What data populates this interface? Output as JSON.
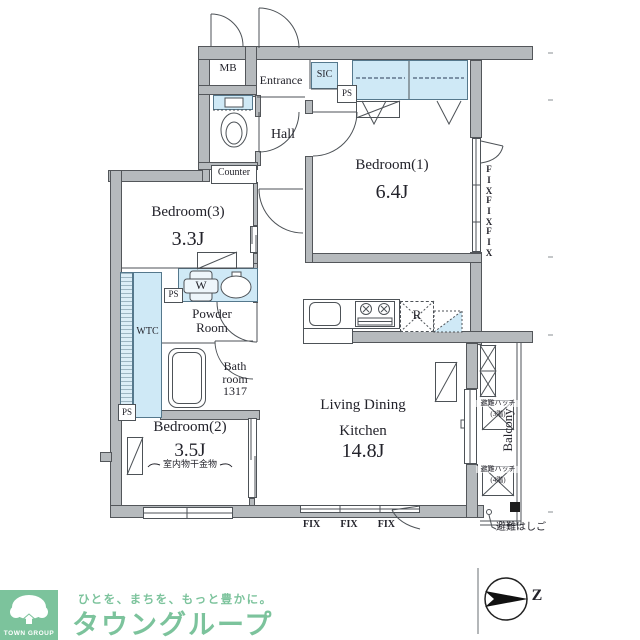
{
  "floorplan": {
    "labels": {
      "mb": "MB",
      "entrance": "Entrance",
      "sic": "SIC",
      "ps": "PS",
      "hall": "Hall",
      "counter": "Counter",
      "wtc": "WTC",
      "washer": "W",
      "fridge": "R",
      "balcony": "Balcony",
      "fix": "FIX"
    },
    "rooms": {
      "bedroom1": {
        "name": "Bedroom(1)",
        "area": "6.4J"
      },
      "bedroom3": {
        "name": "Bedroom(3)",
        "area": "3.3J"
      },
      "bedroom2": {
        "name": "Bedroom(2)",
        "area": "3.5J",
        "note": "室内物干金物"
      },
      "ldk": {
        "line1": "Living Dining",
        "line2": "Kitchen",
        "area": "14.8J"
      },
      "powder": {
        "line1": "Powder",
        "line2": "Room"
      },
      "bath": {
        "line1": "Bath",
        "line2": "room",
        "line3": "1317"
      }
    },
    "annotations": {
      "hatch_upper_label": "避難ハッチ",
      "hatch_upper_floor": "(3階)",
      "hatch_lower_label": "避難ハッチ",
      "hatch_lower_floor": "(4階)",
      "escape_ladder": "避難はしご",
      "north": "Z"
    }
  },
  "footer": {
    "logo": "TOWN GROUP",
    "tagline": "ひとを、まちを、もっと豊かに。",
    "company": "タウングループ"
  },
  "colors": {
    "wall_fill": "#b6babd",
    "wall_line": "#4d5257",
    "fixture_blue": "#cfe9f6",
    "brand_green": "#7cc39c",
    "text": "#23232b"
  }
}
